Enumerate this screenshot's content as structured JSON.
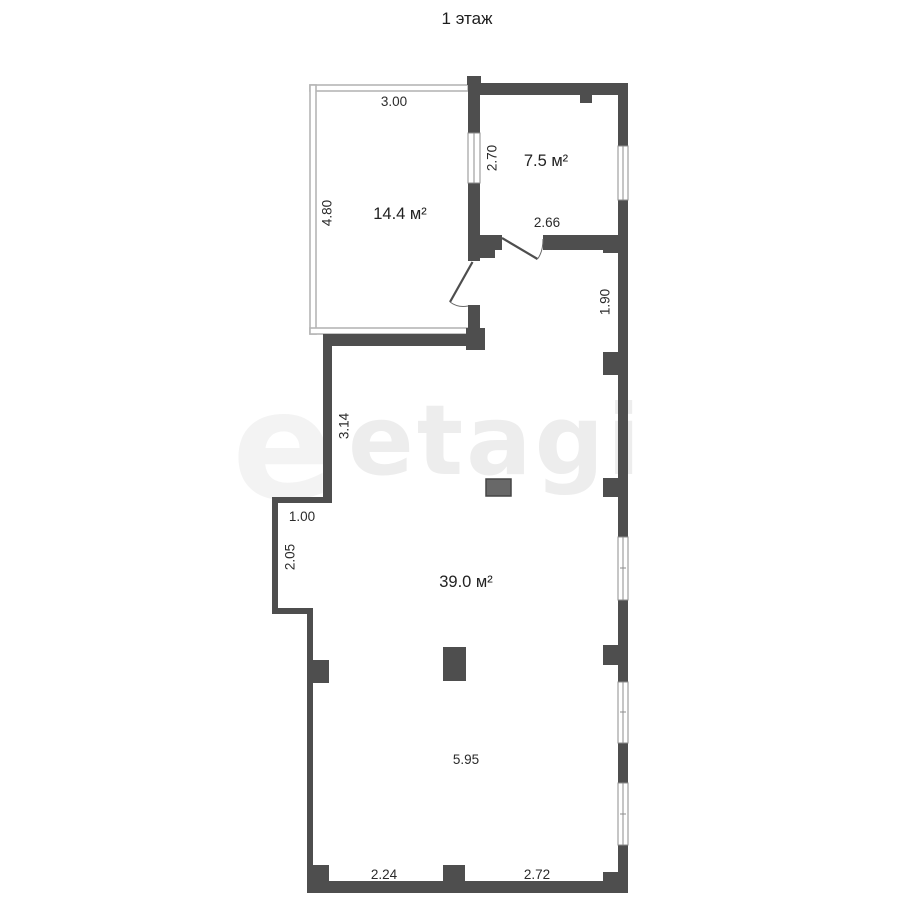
{
  "title": "1 этаж",
  "watermark": {
    "text": "etagi",
    "partial": "e"
  },
  "colors": {
    "wall": "#4e4e4e",
    "balcony_wall": "#b5b5b5",
    "window_line": "#8c8c8c",
    "watermark": "#ededed",
    "dimension_text": "#2b2b2b",
    "vent": "#686868"
  },
  "rooms": {
    "loggia": {
      "area": "14.4 м²"
    },
    "small": {
      "area": "7.5 м²"
    },
    "main": {
      "area": "39.0 м²"
    }
  },
  "dims": {
    "loggia_width": "3.00",
    "loggia_height": "4.80",
    "small_height": "2.70",
    "small_width": "2.66",
    "corridor_height": "1.90",
    "main_left_upper": "3.14",
    "niche_width": "1.00",
    "niche_height": "2.05",
    "main_width": "5.95",
    "bottom_left": "2.24",
    "bottom_right": "2.72"
  }
}
